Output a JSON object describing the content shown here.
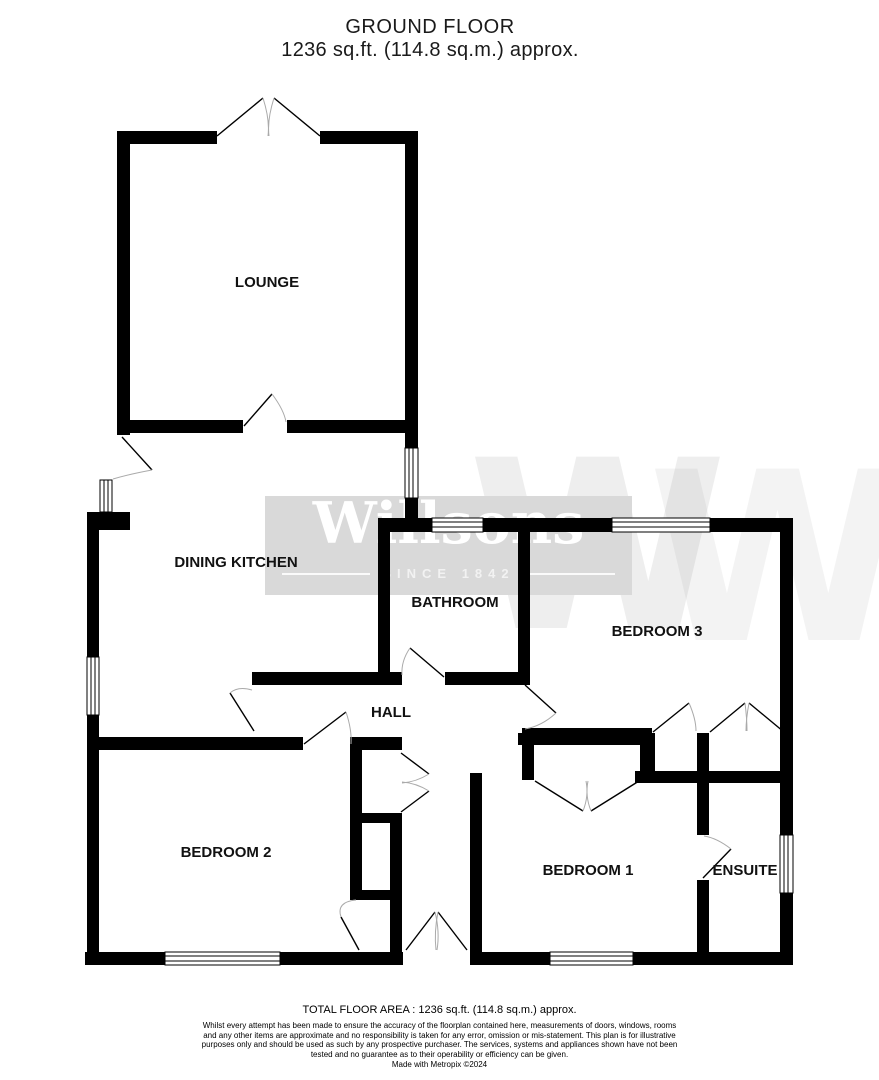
{
  "title": {
    "line1": "GROUND FLOOR",
    "line2": "1236 sq.ft. (114.8 sq.m.) approx."
  },
  "rooms": {
    "lounge": {
      "label": "LOUNGE"
    },
    "dining_kitchen": {
      "label": "DINING KITCHEN"
    },
    "bathroom": {
      "label": "BATHROOM"
    },
    "bedroom3": {
      "label": "BEDROOM 3"
    },
    "hall": {
      "label": "HALL"
    },
    "bedroom2": {
      "label": "BEDROOM 2"
    },
    "bedroom1": {
      "label": "BEDROOM 1"
    },
    "ensuite": {
      "label": "ENSUITE"
    }
  },
  "watermark": {
    "name": "Willsons",
    "tagline": "SINCE 1842",
    "monogram": "W"
  },
  "footer": {
    "total_area": "TOTAL FLOOR AREA : 1236 sq.ft. (114.8 sq.m.) approx.",
    "disclaimer": "Whilst every attempt has been made to ensure the accuracy of the floorplan contained here, measurements of doors, windows, rooms and any other items are approximate and no responsibility is taken for any error, omission or mis-statement. This plan is for illustrative purposes only and should be used as such by any prospective purchaser. The services, systems and appliances shown have not been tested and no guarantee as to their operability or efficiency can be given.",
    "credit": "Made with Metropix ©2024"
  },
  "colors": {
    "wall": "#000000",
    "door_arc": "#aaaaaa",
    "watermark_box": "#d9d9d9"
  }
}
